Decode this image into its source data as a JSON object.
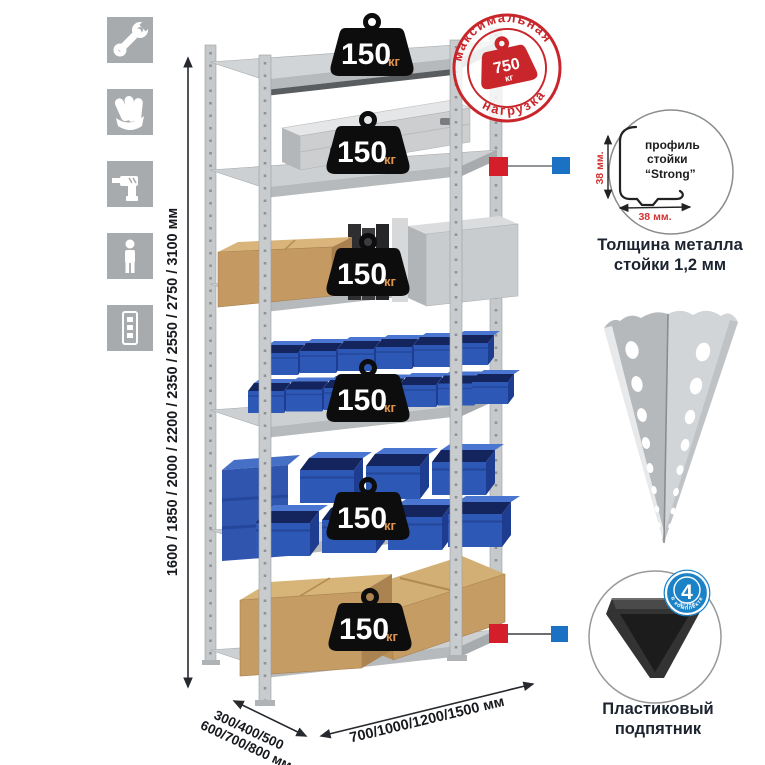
{
  "icons": [
    "wrench",
    "gloves",
    "drill",
    "person",
    "rack-upright"
  ],
  "dimensions": {
    "height_label": "1600 / 1850 / 2000 / 2200 / 2350 / 2550 / 2750 / 3100 мм",
    "depth_label_line1": "300/400/500",
    "depth_label_line2": "600/700/800 мм",
    "width_label": "700/1000/1200/1500 мм"
  },
  "weight_badge": {
    "value": "150",
    "unit": "кг"
  },
  "max_load_stamp": {
    "arc_top": "максимальная",
    "arc_bottom": "нагрузка",
    "value": "750",
    "unit": "кг"
  },
  "profile_detail": {
    "line1": "профиль",
    "line2": "стойки",
    "line3": "“Strong”",
    "dim_vertical": "38 мм.",
    "dim_horizontal": "38 мм.",
    "caption_line1": "Толщина металла",
    "caption_line2": "стойки 1,2 мм"
  },
  "foot_detail": {
    "badge_value": "4",
    "badge_sub": "штуки",
    "badge_arc": "в комплекте",
    "caption_line1": "Пластиковый",
    "caption_line2": "подпятник"
  },
  "colors": {
    "accent_red": "#d41f2a",
    "accent_blue": "#1b72c4",
    "stamp_red": "#c8262b",
    "dim_red": "#d23333",
    "bin_blue": "#2e58b6",
    "box_tan": "#c59c63",
    "metal_gray": "#c6c9cb",
    "icon_gray": "#a7abae",
    "badge_black": "#0d0d0d",
    "badge_unit_orange": "#e2954f"
  }
}
